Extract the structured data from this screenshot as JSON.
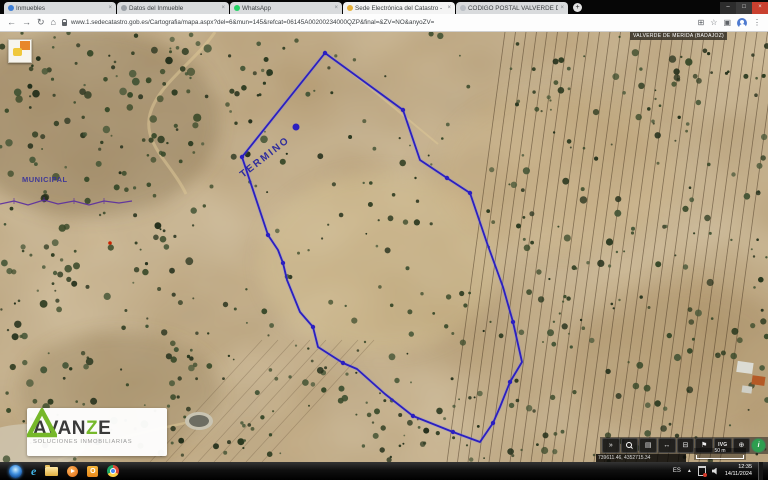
{
  "browser": {
    "tabs": [
      {
        "title": "Inmuebles",
        "favicon": "globe-blue"
      },
      {
        "title": "Datos del Inmueble",
        "favicon": "document-gray"
      },
      {
        "title": "WhatsApp",
        "favicon": "whatsapp-green"
      },
      {
        "title": "Sede Electrónica del Catastro -",
        "favicon": "catastro-yellow"
      },
      {
        "title": "CODIGO POSTAL VALVERDE DE",
        "favicon": "page-gray"
      }
    ],
    "tab_close_glyph": "×",
    "new_tab_glyph": "+",
    "window_controls": {
      "minimize": "–",
      "maximize": "□",
      "close": "×"
    },
    "nav": {
      "back": "←",
      "forward": "→",
      "reload": "↻",
      "home": "⌂"
    },
    "url": "www.1.sedecatastro.gob.es/Cartografia/mapa.aspx?del=6&mun=145&refcat=06145A00200234000QZP&final=&ZV=NO&anyoZV=",
    "actions": {
      "install": "⊞",
      "bookmark": "☆",
      "tab_search": "▣",
      "menu": "⋮"
    }
  },
  "map": {
    "region_label": "VALVERDE DE MERIDA (BADAJOZ)",
    "labels": {
      "termino": "TERMINO",
      "municipal": "MUNICIPAL"
    },
    "parcel": {
      "stroke": "#2b1fc0",
      "points": [
        [
          325,
          21
        ],
        [
          403,
          78
        ],
        [
          420,
          128
        ],
        [
          447,
          146
        ],
        [
          470,
          161
        ],
        [
          487,
          211
        ],
        [
          503,
          255
        ],
        [
          513,
          290
        ],
        [
          522,
          330
        ],
        [
          510,
          350
        ],
        [
          500,
          375
        ],
        [
          493,
          391
        ],
        [
          480,
          410
        ],
        [
          453,
          400
        ],
        [
          433,
          392
        ],
        [
          413,
          384
        ],
        [
          385,
          362
        ],
        [
          357,
          337
        ],
        [
          343,
          331
        ],
        [
          318,
          315
        ],
        [
          313,
          295
        ],
        [
          300,
          280
        ],
        [
          287,
          248
        ],
        [
          283,
          231
        ],
        [
          278,
          218
        ],
        [
          268,
          203
        ],
        [
          242,
          125
        ]
      ],
      "vertex_dots": [
        [
          325,
          21
        ],
        [
          403,
          78
        ],
        [
          447,
          146
        ],
        [
          470,
          161
        ],
        [
          513,
          290
        ],
        [
          510,
          350
        ],
        [
          493,
          391
        ],
        [
          453,
          400
        ],
        [
          413,
          384
        ],
        [
          343,
          331
        ],
        [
          313,
          295
        ],
        [
          283,
          231
        ],
        [
          268,
          203
        ],
        [
          242,
          125
        ],
        [
          296,
          95
        ]
      ]
    },
    "toolbar": {
      "buttons": [
        "chevron",
        "zoom",
        "layers",
        "measure",
        "print",
        "pin",
        "ivg",
        "globe",
        "info"
      ],
      "ivg_label": "IVG",
      "info_label": "i"
    },
    "coordinates": "739611.46, 4352715.34",
    "scale_label": "50 m"
  },
  "watermark": {
    "brand_parts": [
      "AVAN",
      "Z",
      "E"
    ],
    "tagline": "SOLUCIONES INMOBILIARIAS",
    "accent_color": "#76b82a"
  },
  "taskbar": {
    "language": "ES",
    "tray_expand": "▲",
    "time": "12:35",
    "date": "14/11/2024"
  }
}
